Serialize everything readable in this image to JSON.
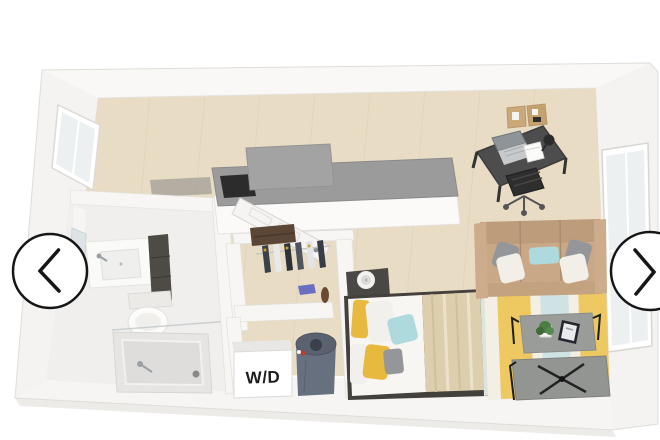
{
  "view": {
    "width": 660,
    "height": 440
  },
  "carousel": {
    "prev_button": {
      "icon": "chevron-left-icon"
    },
    "next_button": {
      "icon": "chevron-right-icon"
    }
  },
  "floorplan": {
    "type": "3d-isometric-studio-apartment-floor-plan",
    "labels": {
      "washer_dryer": "W/D"
    },
    "scene": {
      "rooms": [
        {
          "name": "bathroom",
          "items": [
            "vanity-sink",
            "mirror",
            "toilet",
            "walk-in-shower"
          ]
        },
        {
          "name": "kitchen",
          "items": [
            "gray-counter",
            "cooktop",
            "upper-cabinet-block"
          ]
        },
        {
          "name": "closet",
          "items": [
            "shelf-duffel-bag",
            "hanging-clothes",
            "folded-item"
          ]
        },
        {
          "name": "laundry-nook",
          "items": [
            "washer-dryer-cube",
            "water-heater-cylinder"
          ]
        },
        {
          "name": "sleeping-area",
          "items": [
            "bed",
            "striped-blanket",
            "pillows",
            "nightstand",
            "lamp",
            "foot-bench"
          ]
        },
        {
          "name": "living-area",
          "items": [
            "tan-sofa",
            "throw-pillows",
            "striped-rug",
            "coffee-table",
            "plant",
            "tablet",
            "media-table"
          ]
        },
        {
          "name": "work-area",
          "items": [
            "desk",
            "laptop",
            "notebook",
            "desk-lamp",
            "office-chair",
            "corkboard"
          ]
        }
      ],
      "windows": [
        "left-wall-window",
        "right-wall-window"
      ],
      "door": "entry-door-open"
    }
  },
  "colors": {
    "background": "#ffffff",
    "wall": "#f7f6f4",
    "wall_top": "#d9d7d3",
    "floor_wood": "#e8dcc5",
    "plank_line": "#d9cbb0",
    "bath_floor": "#f0efed",
    "counter_top": "#9b9b9b",
    "cooktop": "#2c2c2c",
    "sofa": "#c9a886",
    "rug_yellow": "#eec961",
    "rug_blue": "#cfe3e5",
    "rug_cream": "#f3efe4",
    "pillow_yellow": "#e7b93f",
    "pillow_aqua": "#aed9dd",
    "pillow_gray": "#95969a",
    "blanket": "#ddcfae",
    "mattress": "#f7f6f3",
    "washer": "#67707e",
    "desk": "#4d4d4d",
    "chair": "#2e2e2e",
    "table_gray": "#939593",
    "corkboard": "#caa878",
    "duffel": "#5c4736",
    "arrow": "#161616"
  }
}
